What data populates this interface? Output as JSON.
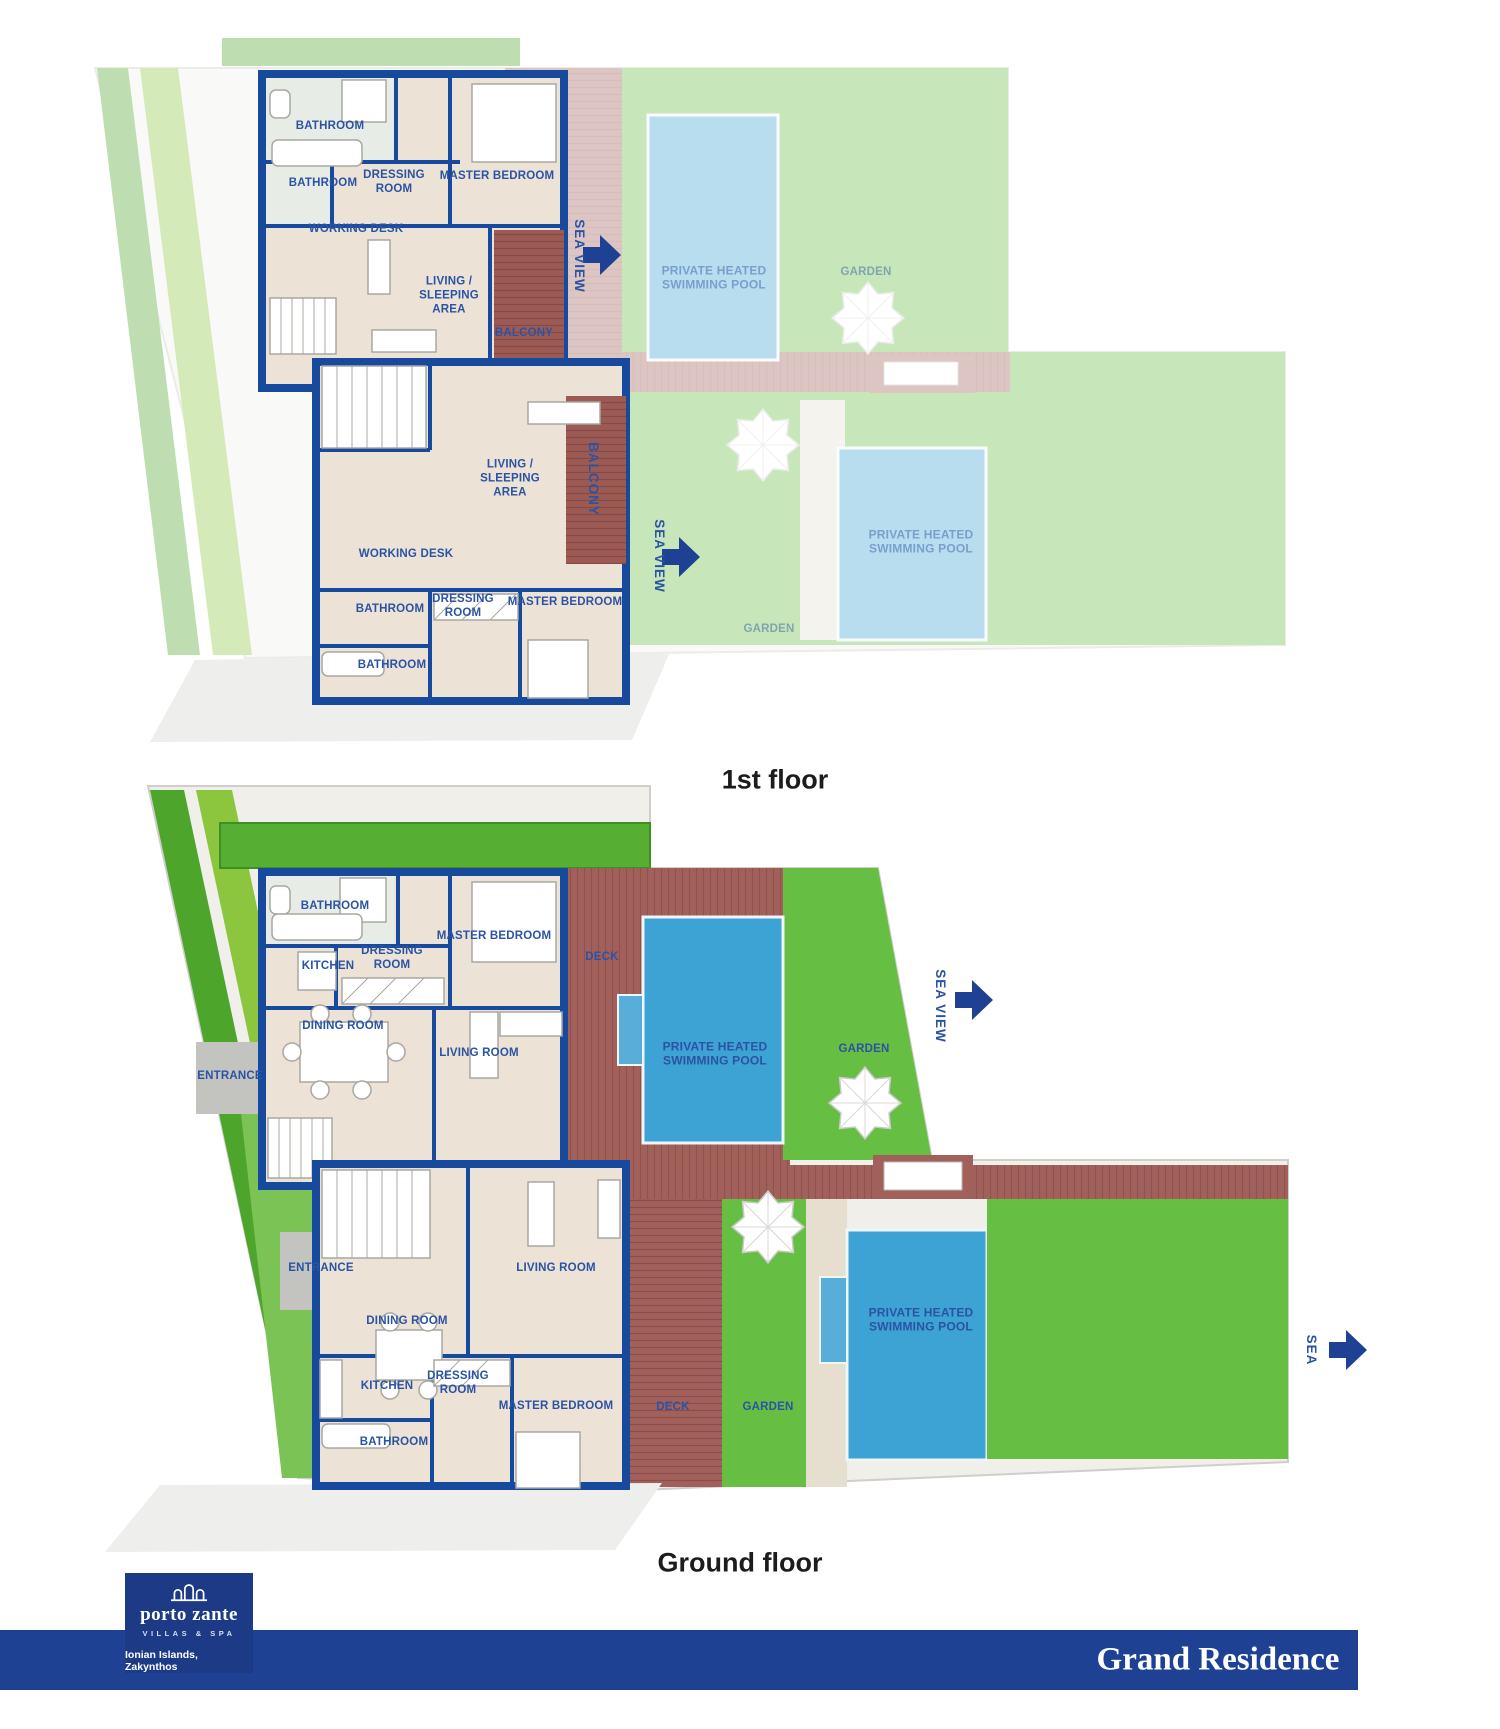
{
  "floor_plans": {
    "first_floor": {
      "title": "1st floor"
    },
    "ground_floor": {
      "title": "Ground floor"
    }
  },
  "labels": {
    "bathroom": "BATHROOM",
    "kitchen": "KITCHEN",
    "dressing_room": "DRESSING ROOM",
    "master_bedroom": "MASTER BEDROOM",
    "working_desk": "WORKING DESK",
    "living_sleeping_area": "LIVING / SLEEPING AREA",
    "living_room": "LIVING ROOM",
    "dining_room": "DINING ROOM",
    "entrance": "ENTRANCE",
    "balcony": "BALCONY",
    "deck": "DECK",
    "garden": "GARDEN",
    "swimming_pool": "PRIVATE HEATED SWIMMING POOL",
    "sea_view": "SEA VIEW",
    "sea": "SEA"
  },
  "footer": {
    "logo": {
      "name": "porto zante",
      "tagline": "VILLAS & SPA",
      "location": "Ionian Islands, Zakynthos"
    },
    "residence_title": "Grand Residence"
  },
  "colors": {
    "wall_blue": "#174a9c",
    "label_blue": "#2b53a4",
    "bar_blue": "#1e4193",
    "logo_blue": "#1c3a86",
    "garden_green": "#66bf43",
    "hedge_green": "#4ea52c",
    "pool_blue": "#3da2d4",
    "deck_red": "#a2605b",
    "balcony_red": "#9c5a55",
    "floor_beige": "#ece2d6",
    "path_gray": "#c3c3c0"
  }
}
